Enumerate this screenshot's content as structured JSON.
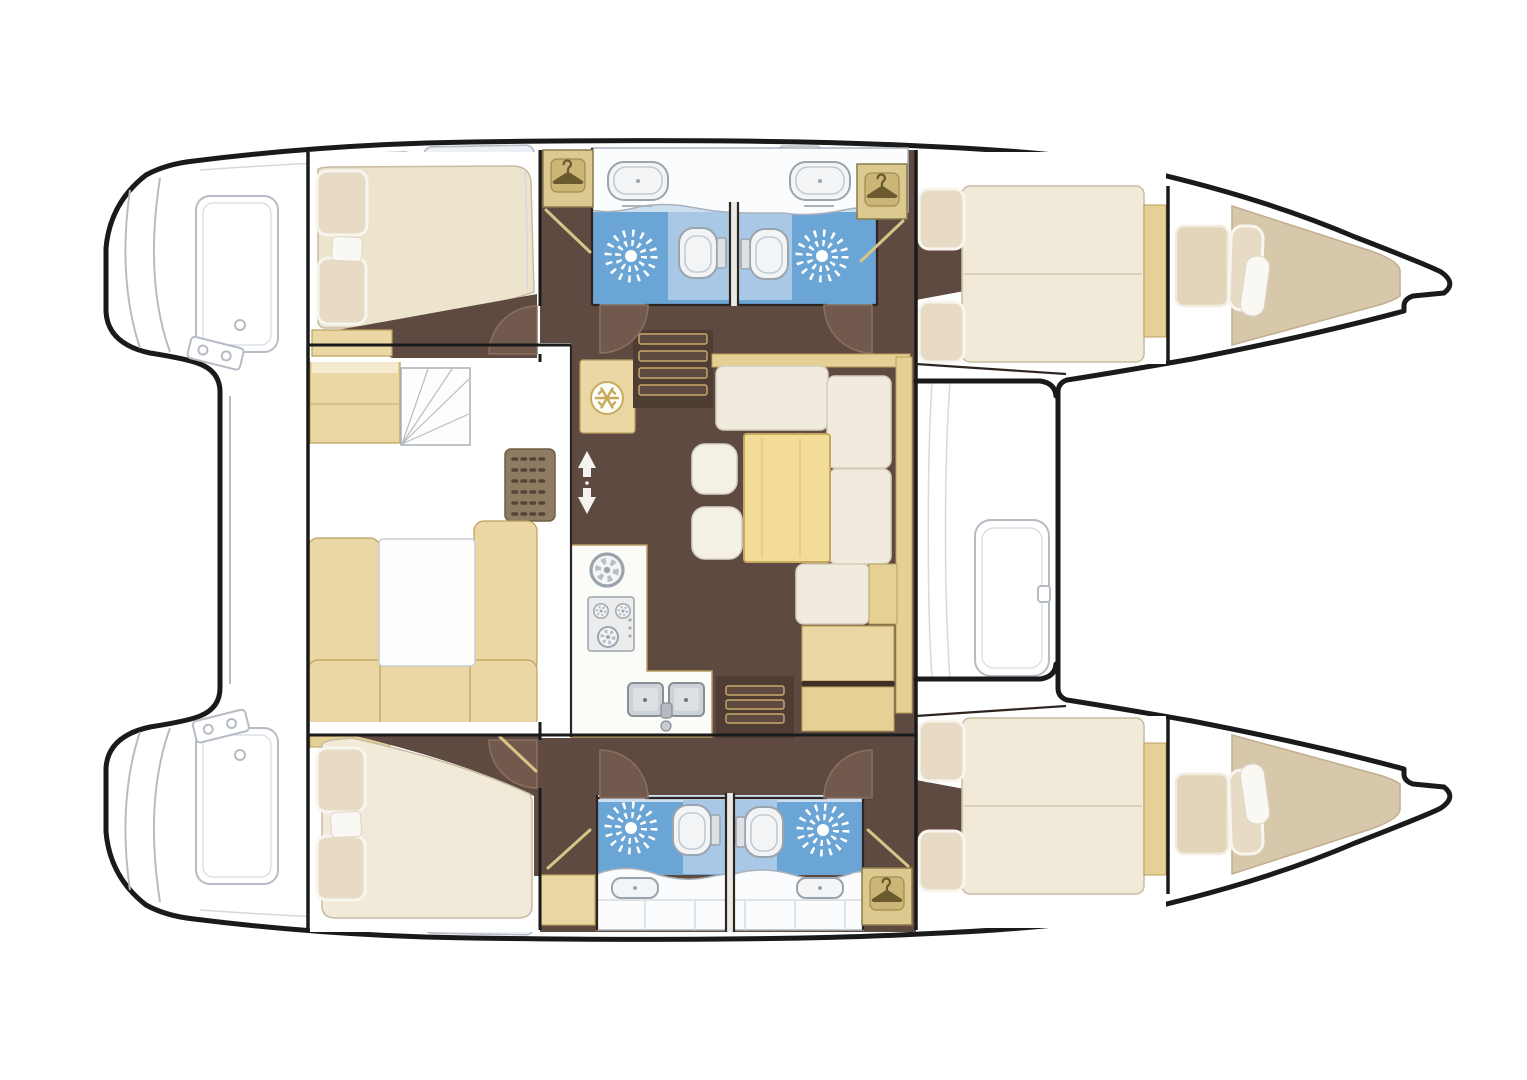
{
  "document": {
    "title": "Catamaran interior layout floor plan — 4 cabins, 4 heads with showers, salon with galley and dinette",
    "type": "floor-plan",
    "orientation": "bows pointing right, sterns left, port hull on top"
  },
  "canvas": {
    "width": 1527,
    "height": 1080,
    "background": "#ffffff"
  },
  "palette": {
    "hull-line": "#1a1a1a",
    "deck-line": "#b6bcc6",
    "deck-line-light": "#d5dae0",
    "hatch-fill": "#edf0f4",
    "floor-brown": "#5e4a41",
    "floor-brown-dark": "#4f3c33",
    "door-swing": "#71594d",
    "door-swing-edge": "#8b7060",
    "wall-dark": "#2e2520",
    "tan": "#ead7a4",
    "tan-rail": "#e5d095",
    "tan-border": "#bba05c",
    "locker-bg": "#dcc98f",
    "locker-tile": "#cbb577",
    "locker-glyph": "#6b5a2e",
    "bath-blue": "#6aa5d5",
    "bath-blue-light": "#a9c8e5",
    "bath-blue-pale": "#cbdff0",
    "fixture-white": "#f2f4f5",
    "fixture-line": "#9aa4ad",
    "cushion-cream": "#f0ebde",
    "cushion-line": "#d6ceba",
    "mattress": "#f1ead8",
    "mattress-line": "#c6bca2",
    "duvet": "#ede4ce",
    "pillow": "#e7dbc5",
    "pillow-line": "#f8f5ee",
    "berth-beige": "#d8c8ab",
    "berth-line": "#c0ae8e",
    "table-yellow": "#f2dc98",
    "table-border": "#c8aa5c",
    "galley-white": "#fbfbf8",
    "steel": "#cdd2d6",
    "steel-line": "#878e95",
    "step-line": "#caa96e",
    "white": "#ffffff"
  },
  "hulls": {
    "port_top": {
      "rooms": [
        "aft double cabin",
        "hanging locker",
        "aft head with shower and toilet",
        "forward head with shower and toilet",
        "hanging locker",
        "forward double cabin",
        "forepeak berth"
      ]
    },
    "starboard_bottom": {
      "rooms": [
        "aft double cabin",
        "storage cabinet",
        "aft head with shower and toilet",
        "forward head with shower and toilet",
        "hanging locker",
        "forward double cabin",
        "forepeak berth"
      ]
    }
  },
  "bridgedeck": {
    "rooms": [
      "navigation desk with chart table",
      "forward U-settee with table",
      "galley with stove and twin sink",
      "refrigerator",
      "dinette with L-settee, table and stools",
      "port companionway stairs",
      "starboard companionway stairs",
      "forward cockpit bench",
      "aft deck",
      "trampoline area"
    ]
  },
  "counts": {
    "double_cabins": 4,
    "forepeak_berths": 2,
    "heads": 4,
    "shower_suns": 4,
    "toilets": 4,
    "hanger_lockers": 3,
    "vanity_sinks": 4,
    "galley_sinks": 2,
    "stove_burners": 3,
    "stools": 2
  },
  "icons": [
    {
      "name": "hanger-icon",
      "meaning": "hanging wardrobe locker"
    },
    {
      "name": "shower-sun-icon",
      "meaning": "shower floor drain sunburst"
    },
    {
      "name": "toilet-icon",
      "meaning": "marine toilet"
    },
    {
      "name": "sink-icon",
      "meaning": "vanity wash basin"
    },
    {
      "name": "double-sink-icon",
      "meaning": "galley twin sink with faucet"
    },
    {
      "name": "burner-icon",
      "meaning": "stove burner ring"
    },
    {
      "name": "snowflake-icon",
      "meaning": "refrigerator"
    },
    {
      "name": "stairs-icon",
      "meaning": "companionway steps"
    },
    {
      "name": "up-down-arrow-icon",
      "meaning": "companionway up/down"
    },
    {
      "name": "door-swing-icon",
      "meaning": "door swing arc"
    },
    {
      "name": "chart-fan-icon",
      "meaning": "nav chart table"
    },
    {
      "name": "speaker-grille-icon",
      "meaning": "vent / speaker grille"
    }
  ]
}
